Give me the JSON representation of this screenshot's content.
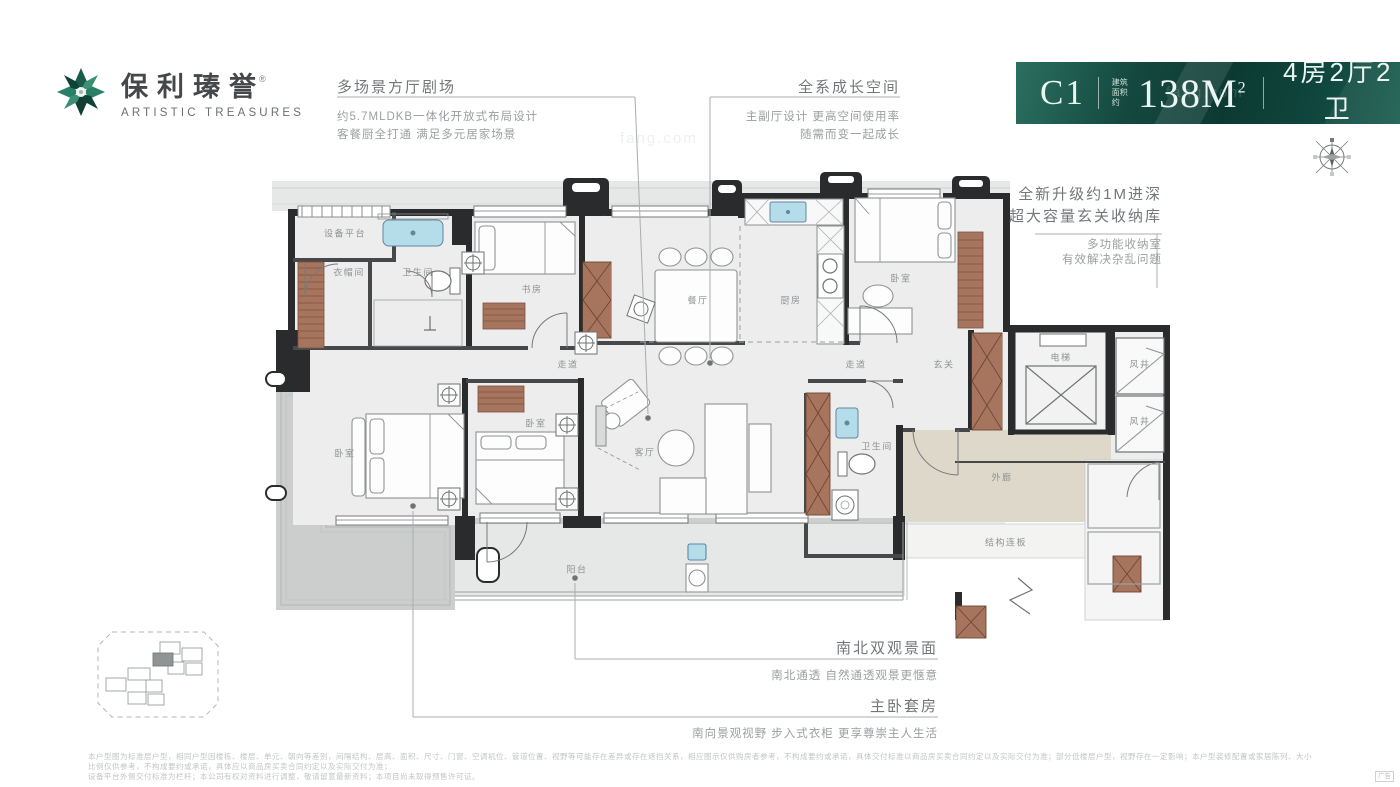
{
  "brand": {
    "name_cn": "保利瑧誉",
    "reg_mark": "®",
    "name_en": "ARTISTIC TREASURES"
  },
  "badge": {
    "unit": "C1",
    "area_prefix_line1": "建筑",
    "area_prefix_line2": "面积约",
    "area_value": "138M",
    "area_sup": "2",
    "rooms": "4房2厅2卫",
    "rooms_sub": "ARTISTIC TREASURES"
  },
  "annotations": {
    "a1": {
      "title": "多场景方厅剧场",
      "line1": "约5.7MLDKB一体化开放式布局设计",
      "line2": "客餐厨全打通 满足多元居家场景"
    },
    "a2": {
      "title": "全系成长空间",
      "line1": "主副厅设计 更高空间使用率",
      "line2": "随需而变一起成长"
    },
    "a3": {
      "title_line1": "全新升级约1M进深",
      "title_line2": "超大容量玄关收纳库",
      "line1": "多功能收纳室",
      "line2": "有效解决杂乱问题"
    },
    "a4": {
      "title": "南北双观景面",
      "line1": "南北通透 自然通透观景更惬意"
    },
    "a5": {
      "title": "主卧套房",
      "line1": "南向景观视野 步入式衣柜 更享尊崇主人生活"
    }
  },
  "rooms": {
    "equipment_platform": "设备平台",
    "cloakroom": "衣帽间",
    "bath_1": "卫生间",
    "study": "书房",
    "dining": "餐厅",
    "kitchen": "厨房",
    "bedroom_ne": "卧室",
    "corridor_w": "走道",
    "corridor_e": "走道",
    "foyer": "玄关",
    "elevator": "电梯",
    "shaft_1": "风井",
    "shaft_2": "风井",
    "bath_2": "卫生间",
    "outer_corridor": "外廊",
    "structure_slab": "结构连板",
    "bedroom_sw": "卧室",
    "bedroom_s": "卧室",
    "living": "客厅",
    "balcony": "阳台"
  },
  "disclaimer": {
    "line1": "本户型图为标准层户型，相同户型因楼栋、楼层、单元、朝向等差别，间隔结构、层高、面积、尺寸、门窗、空调机位、管道位置、视野等可能存在差异或存在遮挡关系，相应图示仅供购房者参考，不构成要约或承诺，具体交付标准以商品房买卖合同约定以及实际交付为准；部分低楼层户型，视野存在一定影响；本户型装修配置或家居陈列、大小比例仅供参考，不构成要约或承诺，具体应以商品房买卖合同约定以及实际交付为准；",
    "line2": "设备平台外侧交付标准为栏杆；本公司有权对资料进行调整，敬请留意最新资料；本项目尚未取得预售许可证。"
  },
  "ad_tag": "广告",
  "watermark": "fang.com",
  "colors": {
    "badge_green_dark": "#0c3a33",
    "badge_green_light": "#2b6f5f",
    "wall": "#2a2b2d",
    "wood": "#a7755e",
    "fixture_blue": "#b5dde9",
    "outer_corridor_beige": "#ddd8c9",
    "terrace_gray": "#cbcecd"
  }
}
